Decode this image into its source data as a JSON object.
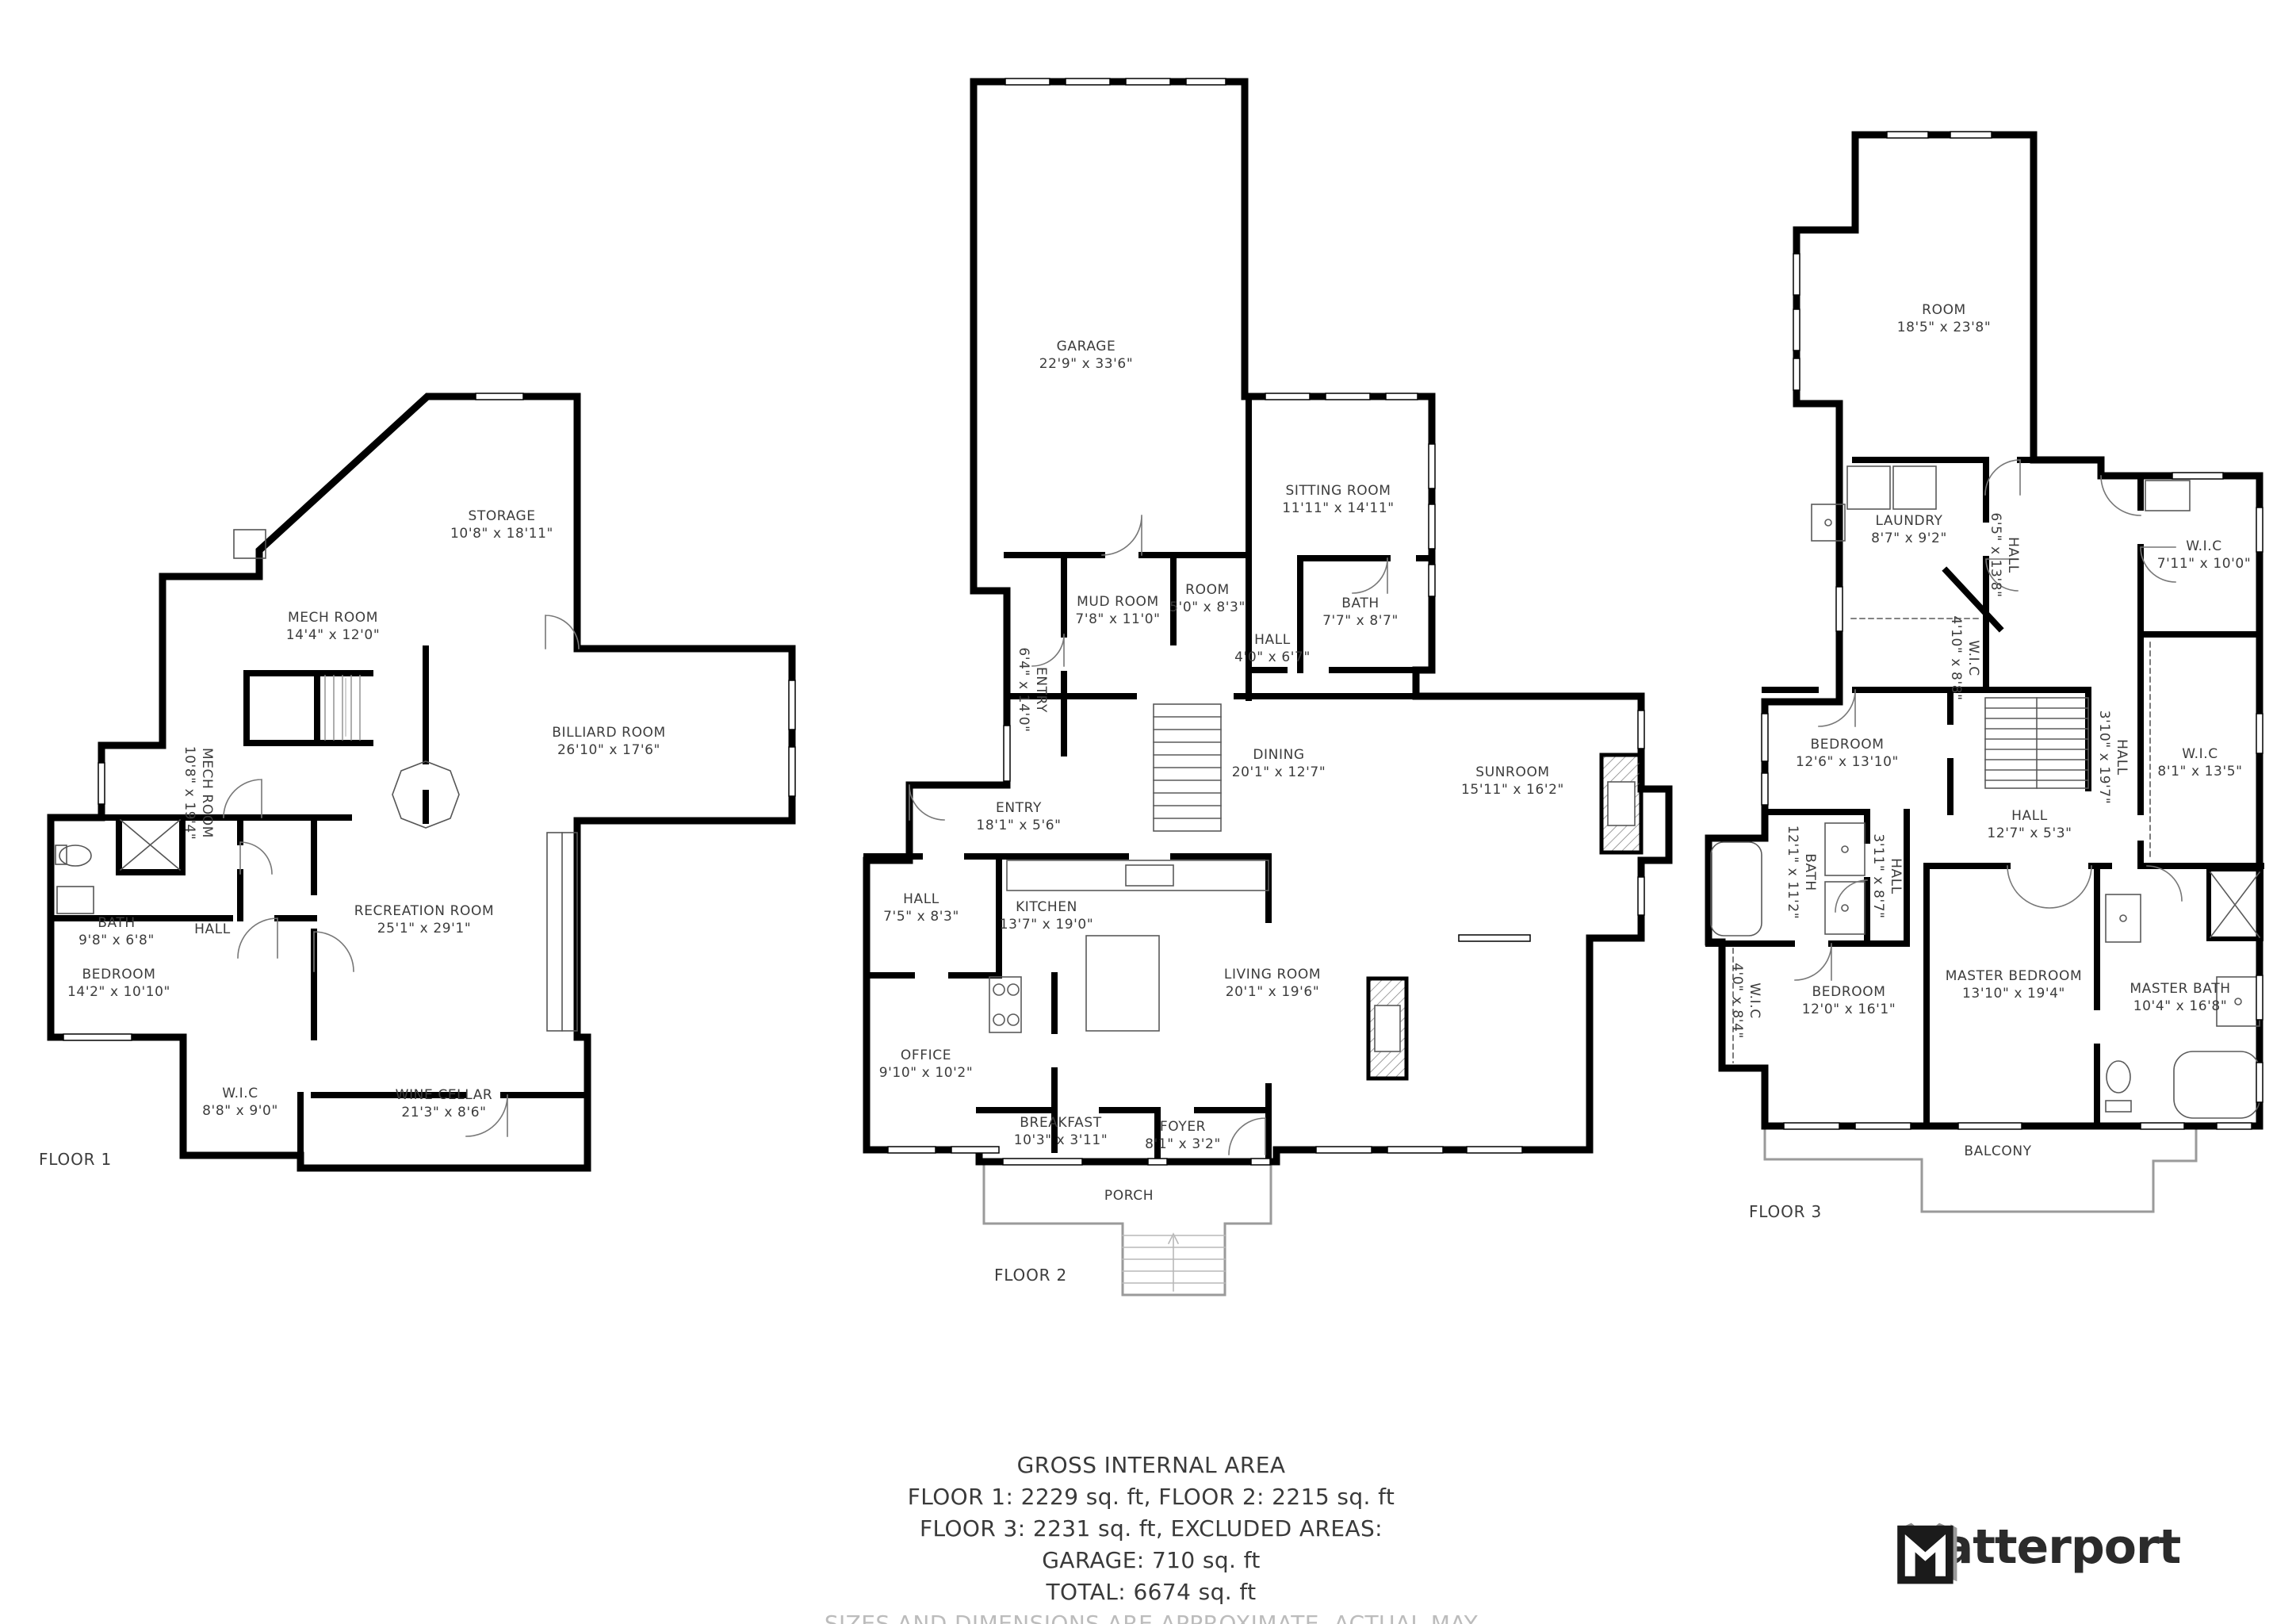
{
  "floors": [
    {
      "label": "FLOOR 1",
      "rooms": [
        {
          "name": "STORAGE",
          "dims": "10'8\" x 18'11\""
        },
        {
          "name": "MECH ROOM",
          "dims": "14'4\" x 12'0\""
        },
        {
          "name": "MECH ROOM",
          "dims": "10'8\" x 19'4\""
        },
        {
          "name": "BILLIARD ROOM",
          "dims": "26'10\" x 17'6\""
        },
        {
          "name": "RECREATION ROOM",
          "dims": "25'1\" x 29'1\""
        },
        {
          "name": "BATH",
          "dims": "9'8\" x 6'8\""
        },
        {
          "name": "HALL",
          "dims": ""
        },
        {
          "name": "BEDROOM",
          "dims": "14'2\" x 10'10\""
        },
        {
          "name": "W.I.C",
          "dims": "8'8\" x 9'0\""
        },
        {
          "name": "WINE CELLAR",
          "dims": "21'3\" x 8'6\""
        }
      ]
    },
    {
      "label": "FLOOR 2",
      "rooms": [
        {
          "name": "GARAGE",
          "dims": "22'9\" x 33'6\""
        },
        {
          "name": "SITTING ROOM",
          "dims": "11'11\" x 14'11\""
        },
        {
          "name": "MUD ROOM",
          "dims": "7'8\" x 11'0\""
        },
        {
          "name": "ROOM",
          "dims": "5'0\" x 8'3\""
        },
        {
          "name": "BATH",
          "dims": "7'7\" x 8'7\""
        },
        {
          "name": "HALL",
          "dims": "4'0\" x 6'7\""
        },
        {
          "name": "ENTRY",
          "dims": "6'4\" x 14'0\""
        },
        {
          "name": "DINING",
          "dims": "20'1\" x 12'7\""
        },
        {
          "name": "SUNROOM",
          "dims": "15'11\" x 16'2\""
        },
        {
          "name": "ENTRY",
          "dims": "18'1\" x 5'6\""
        },
        {
          "name": "HALL",
          "dims": "7'5\" x 8'3\""
        },
        {
          "name": "KITCHEN",
          "dims": "13'7\" x 19'0\""
        },
        {
          "name": "LIVING ROOM",
          "dims": "20'1\" x 19'6\""
        },
        {
          "name": "OFFICE",
          "dims": "9'10\" x 10'2\""
        },
        {
          "name": "BREAKFAST",
          "dims": "10'3\" x 3'11\""
        },
        {
          "name": "FOYER",
          "dims": "8'1\" x 3'2\""
        },
        {
          "name": "PORCH",
          "dims": ""
        }
      ]
    },
    {
      "label": "FLOOR 3",
      "rooms": [
        {
          "name": "ROOM",
          "dims": "18'5\" x 23'8\""
        },
        {
          "name": "LAUNDRY",
          "dims": "8'7\" x 9'2\""
        },
        {
          "name": "HALL",
          "dims": "6'5\" x 13'8\""
        },
        {
          "name": "W.I.C",
          "dims": "7'11\" x 10'0\""
        },
        {
          "name": "BEDROOM",
          "dims": "12'6\" x 13'10\""
        },
        {
          "name": "W.I.C",
          "dims": "4'10\" x 8'8\""
        },
        {
          "name": "HALL",
          "dims": "3'10\" x 19'7\""
        },
        {
          "name": "HALL",
          "dims": "12'7\" x 5'3\""
        },
        {
          "name": "W.I.C",
          "dims": "8'1\" x 13'5\""
        },
        {
          "name": "BATH",
          "dims": "12'1\" x 11'2\""
        },
        {
          "name": "HALL",
          "dims": "3'11\" x 8'7\""
        },
        {
          "name": "W.I.C",
          "dims": "4'0\" x 8'4\""
        },
        {
          "name": "BEDROOM",
          "dims": "12'0\" x 16'1\""
        },
        {
          "name": "MASTER BEDROOM",
          "dims": "13'10\" x 19'4\""
        },
        {
          "name": "MASTER BATH",
          "dims": "10'4\" x 16'8\""
        },
        {
          "name": "BALCONY",
          "dims": ""
        }
      ]
    }
  ],
  "footer": {
    "title": "GROSS INTERNAL AREA",
    "line1": "FLOOR 1: 2229 sq. ft, FLOOR 2: 2215 sq. ft",
    "line2": "FLOOR 3: 2231 sq. ft, EXCLUDED AREAS:",
    "line3": "GARAGE: 710 sq. ft",
    "line4": "TOTAL: 6674 sq. ft",
    "disclaimer": "SIZES AND DIMENSIONS ARE APPROXIMATE, ACTUAL MAY VARY."
  },
  "brand": {
    "name": "Matterport"
  },
  "colors": {
    "wall": "#000000",
    "fixture": "#5a5a5a",
    "porch_outline": "#9a9a9a",
    "label": "#3c3c3c",
    "disclaimer": "#bcbcbc",
    "brand_text": "#2b2b2b"
  }
}
